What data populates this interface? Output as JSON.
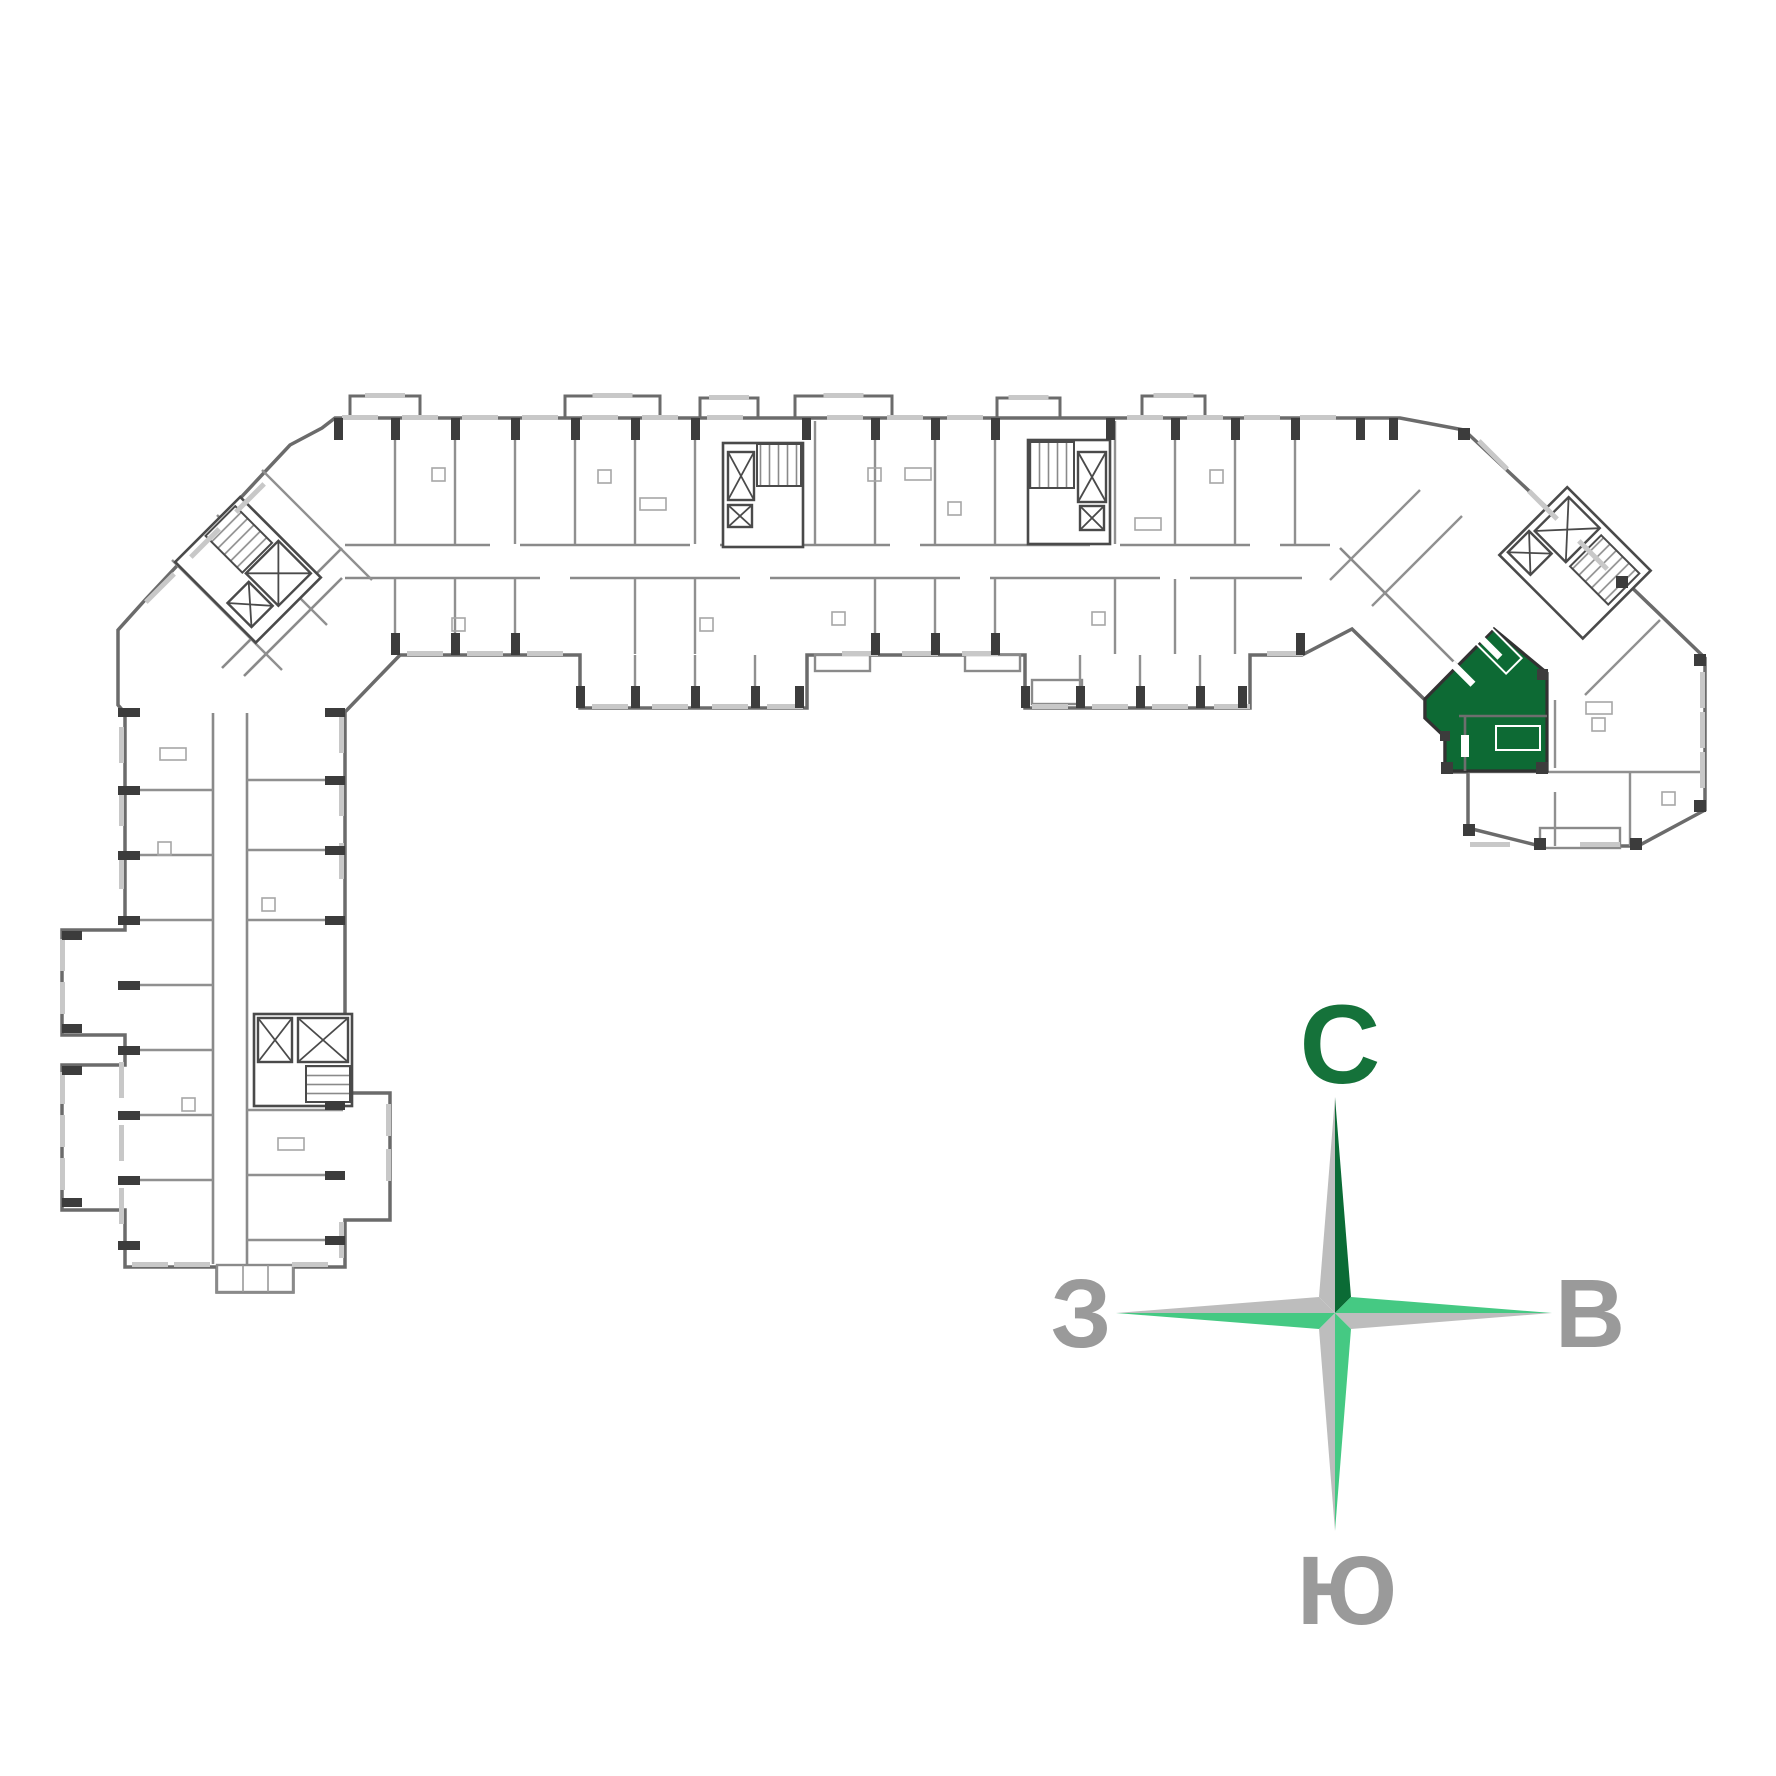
{
  "page": {
    "background_color": "#ffffff"
  },
  "floor_plan": {
    "description": "residential building floor plan, bent multi-section slab with two angled wings and a lower tower section",
    "selected_apartment": {
      "highlight_color": "#0d6a34",
      "outline_color": "#323232"
    },
    "wall_colors": {
      "outer": "#6b6b6b",
      "partition": "#909090",
      "dark_segment": "#3c3c3c",
      "window": "#c8c8c8",
      "fixture": "#a6a6a6"
    }
  },
  "compass": {
    "north_label": "С",
    "east_label": "В",
    "south_label": "Ю",
    "west_label": "З",
    "colors": {
      "north_letter": "#15723a",
      "side_letter": "#9a9a9a",
      "dark_green": "#0b6b35",
      "light_green": "#45c983",
      "gray": "#bdbdbd"
    }
  }
}
